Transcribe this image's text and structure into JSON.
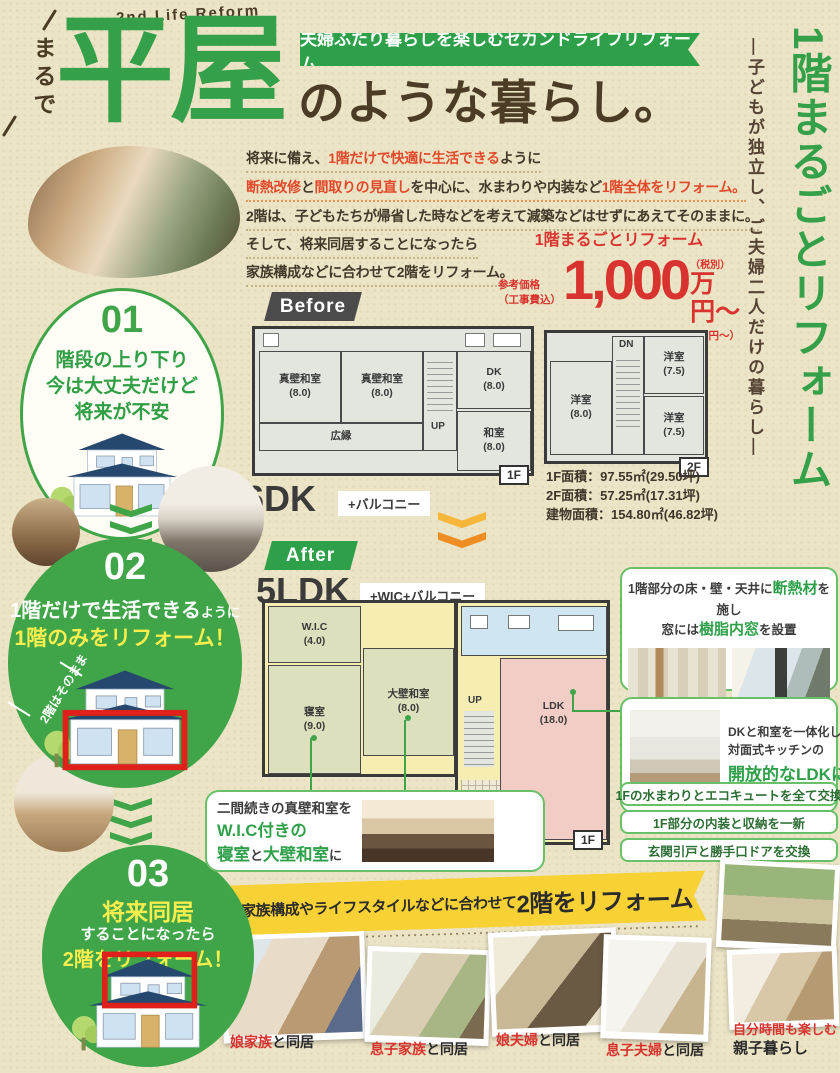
{
  "header": {
    "eyebrow": "2nd Life Reform",
    "vertical_intro": "まるで",
    "title_big": "平屋",
    "title_suffix": "のような暮らし。",
    "ribbon": "夫婦ふたり暮らしを楽しむセカンドライフリフォーム"
  },
  "side": {
    "title": "1階まるごとリフォーム",
    "subtitle": "―子どもが独立し、ご夫婦二人だけの暮らし―"
  },
  "intro": {
    "p1": "将来に備え、",
    "p2": "1階だけで快適に生活できる",
    "p3": "ように",
    "p4": "断熱改修",
    "p5": "と",
    "p6": "間取りの見直し",
    "p7": "を中心に、水まわりや内装など",
    "p8": "1階全体をリフォーム。",
    "l3": "2階は、子どもたちが帰省した時などを考えて減築などはせずにあえてそのままに。",
    "l4": "そして、将来同居することになったら",
    "l5": "家族構成などに合わせて2階をリフォーム。"
  },
  "price": {
    "label": "1階まるごとリフォーム",
    "note1": "参考価格",
    "note2": "（工事費込）",
    "amount": "1,000",
    "tax_note": "（税別）",
    "unit": "万円〜",
    "tax_incl": "（税込1,100万円〜）"
  },
  "steps": {
    "s1": {
      "num": "01",
      "l1": "階段の上り下り",
      "l2": "今は大丈夫だけど",
      "l3": "将来が不安"
    },
    "s2": {
      "num": "02",
      "l1": "1階だけで生活できる",
      "l1s": "ように",
      "l2": "1階のみをリフォーム！",
      "note": "2階はそのまま"
    },
    "s3": {
      "num": "03",
      "l1": "将来同居",
      "l2": "することになったら",
      "l3": "2階をリフォーム！"
    }
  },
  "before": {
    "badge": "Before",
    "plan": "6DK",
    "plan_suffix": "+バルコニー",
    "f1": {
      "room1": "真壁和室",
      "room1s": "(8.0)",
      "room2": "真壁和室",
      "room2s": "(8.0)",
      "dk": "DK",
      "dks": "(8.0)",
      "washitsu": "和室",
      "washitsus": "(8.0)",
      "engawa": "広縁",
      "up": "UP",
      "badge": "1F"
    },
    "f2": {
      "room1": "洋室",
      "room1s": "(8.0)",
      "room2": "洋室",
      "room2s": "(7.5)",
      "room3": "洋室",
      "room3s": "(7.5)",
      "dn": "DN",
      "badge": "2F"
    },
    "areas": {
      "a1l": "1F面積：",
      "a1v": "97.55㎡(29.50坪)",
      "a2l": "2F面積：",
      "a2v": "57.25㎡(17.31坪)",
      "a3l": "建物面積：",
      "a3v": "154.80㎡(46.82坪)"
    }
  },
  "after": {
    "badge": "After",
    "plan": "5LDK",
    "plan_suffix": "+WIC+バルコニー",
    "f1": {
      "wic": "W.I.C",
      "wics": "(4.0)",
      "bedroom": "寝室",
      "bedrooms": "(9.0)",
      "washitsu": "大壁和室",
      "washitsus": "(8.0)",
      "ldk": "LDK",
      "ldks": "(18.0)",
      "up": "UP",
      "badge": "1F"
    }
  },
  "features": {
    "insulation": {
      "t1": "1階部分の床・壁・天井に",
      "t2": "断熱材",
      "t3": "を施し",
      "t4": "窓には",
      "t5": "樹脂内窓",
      "t6": "を設置"
    },
    "ldk": {
      "t1": "DKと和室を一体化して",
      "t2": "対面式キッチンの",
      "t3": "開放的なLDKに"
    },
    "bedroom": {
      "t1": "二間続きの真壁和室を",
      "t2": "W.I.C付きの",
      "t3": "寝室",
      "t4": "と",
      "t5": "大壁和室",
      "t6": "に"
    },
    "pill1": "1Fの水まわりとエコキュートを全て交換",
    "pill2": "1F部分の内装と収納を一新",
    "pill3": "玄関引戸と勝手口ドアを交換"
  },
  "bottom": {
    "banner_a": "家族構成やライフスタイルなどに合わせて",
    "banner_b": "2階をリフォーム",
    "cap1r": "娘家族",
    "cap1b": "と同居",
    "cap2r": "息子家族",
    "cap2b": "と同居",
    "cap3r": "娘夫婦",
    "cap3b": "と同居",
    "cap4r": "息子夫婦",
    "cap4b": "と同居",
    "cap5r": "自分時間も楽しむ",
    "cap5b": "親子暮らし"
  },
  "colors": {
    "green": "#35a04a",
    "price_red": "#d8332e",
    "highlight_red": "#e2492a",
    "banner_yellow": "#f8d234",
    "brown": "#4a3c25"
  }
}
